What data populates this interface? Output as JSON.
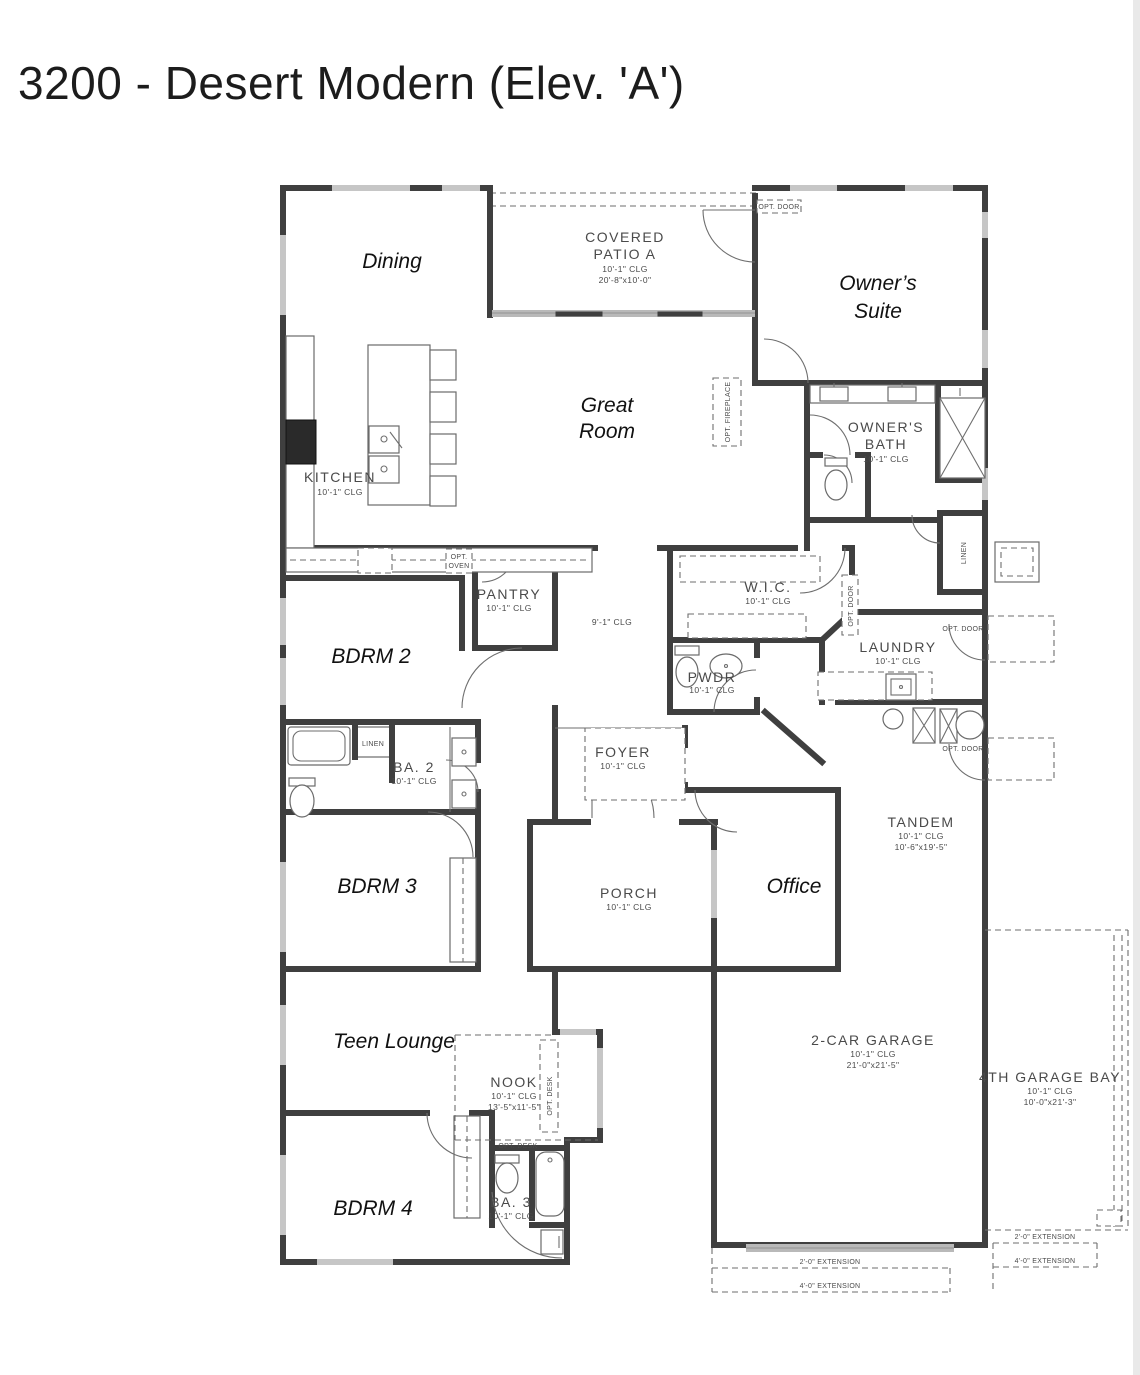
{
  "page": {
    "title": "3200 - Desert Modern (Elev. 'A')"
  },
  "colors": {
    "wall": "#3f3f3f",
    "cad_text": "#4a4a4a",
    "annotation_text": "#111111",
    "window": "#c6c6c6",
    "background": "#ffffff"
  },
  "annotations": {
    "dining": "Dining",
    "owners_suite_1": "Owner’s",
    "owners_suite_2": "Suite",
    "great_room_1": "Great",
    "great_room_2": "Room",
    "bdrm2": "BDRM 2",
    "bdrm3": "BDRM 3",
    "teen_lounge": "Teen Lounge",
    "bdrm4": "BDRM 4",
    "office": "Office"
  },
  "rooms": {
    "covered_patio": {
      "name1": "COVERED",
      "name2": "PATIO A",
      "clg": "10'-1\" CLG",
      "dims": "20'-8\"x10'-0\""
    },
    "kitchen": {
      "name": "KITCHEN",
      "clg": "10'-1\" CLG"
    },
    "owners_bath": {
      "name1": "OWNER'S",
      "name2": "BATH",
      "clg": "10'-1\" CLG"
    },
    "wic": {
      "name": "W.I.C.",
      "clg": "10'-1\" CLG"
    },
    "hall": {
      "clg": "9'-1\" CLG"
    },
    "pantry": {
      "name": "PANTRY",
      "clg": "10'-1\" CLG"
    },
    "laundry": {
      "name": "LAUNDRY",
      "clg": "10'-1\" CLG"
    },
    "pwdr": {
      "name": "PWDR",
      "clg": "10'-1\" CLG"
    },
    "ba2": {
      "name": "BA. 2",
      "clg": "10'-1\" CLG"
    },
    "foyer": {
      "name": "FOYER",
      "clg": "10'-1\" CLG"
    },
    "tandem": {
      "name": "TANDEM",
      "clg": "10'-1\" CLG",
      "dims": "10'-6\"x19'-5\""
    },
    "porch": {
      "name": "PORCH",
      "clg": "10'-1\" CLG"
    },
    "nook": {
      "name": "NOOK",
      "clg": "10'-1\" CLG",
      "dims": "13'-5\"x11'-5\""
    },
    "garage2": {
      "name": "2-CAR GARAGE",
      "clg": "10'-1\" CLG",
      "dims": "21'-0\"x21'-5\""
    },
    "garage4": {
      "name": "4TH GARAGE BAY",
      "clg": "10'-1\" CLG",
      "dims": "10'-0\"x21'-3\""
    },
    "ba3": {
      "name": "BA. 3",
      "clg": "10'-1\" CLG"
    }
  },
  "notes": {
    "opt_door": "OPT. DOOR",
    "opt_oven_1": "OPT.",
    "opt_oven_2": "OVEN",
    "opt_desk": "OPT. DESK",
    "opt_fireplace": "OPT. FIREPLACE",
    "linen": "LINEN",
    "ext_2": "2'-0\" EXTENSION",
    "ext_4": "4'-0\" EXTENSION"
  }
}
